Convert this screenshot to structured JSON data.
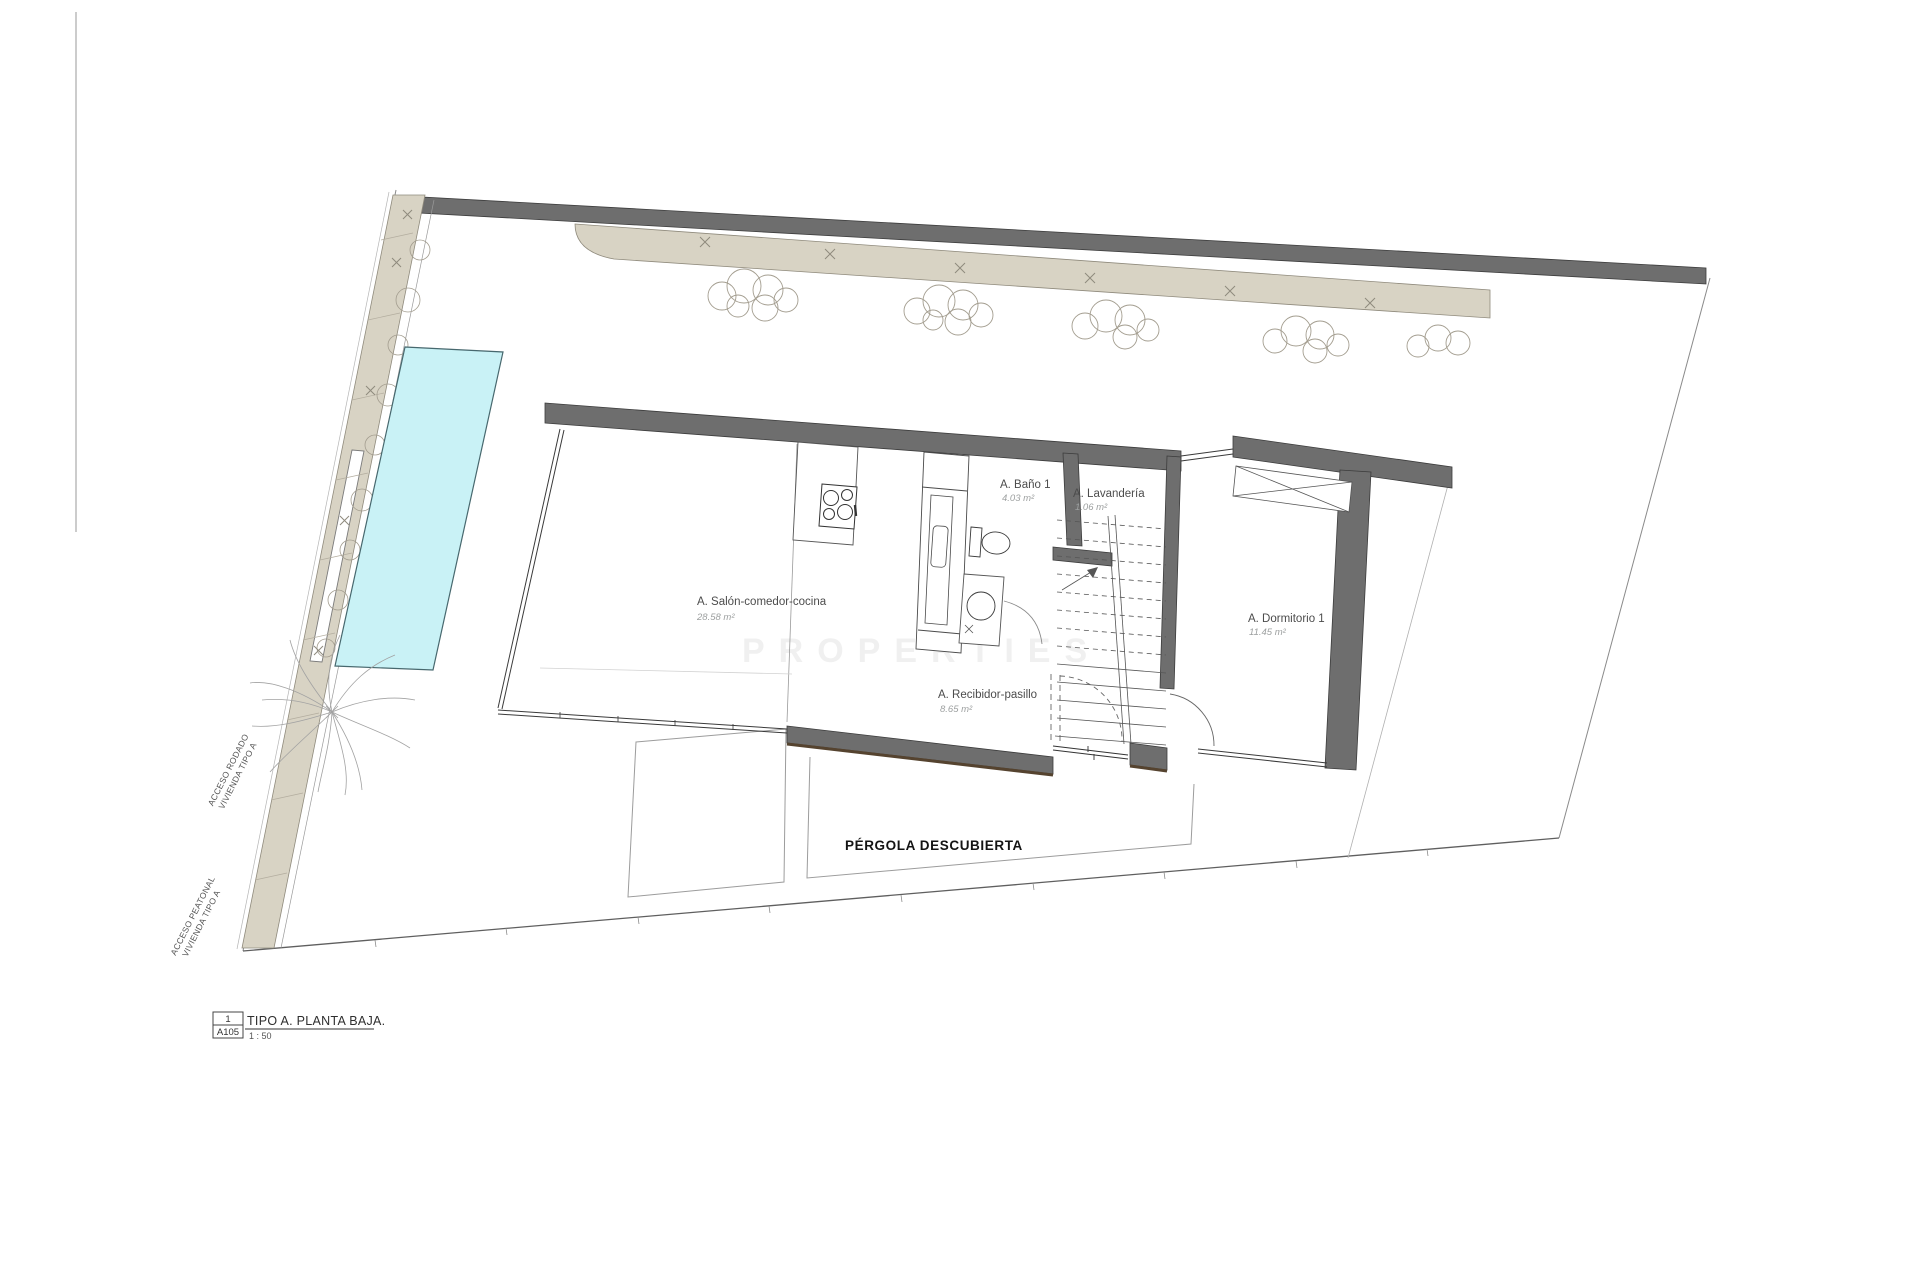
{
  "drawing": {
    "title_block": {
      "index": "1",
      "sheet": "A105",
      "title": "TIPO A. PLANTA BAJA.",
      "scale": "1 : 50"
    },
    "rooms": {
      "salon": {
        "name": "A. Salón-comedor-cocina",
        "area": "28.58 m²"
      },
      "bano": {
        "name": "A. Baño 1",
        "area": "4.03 m²"
      },
      "lavanderia": {
        "name": "A. Lavandería",
        "area": "1.06 m²"
      },
      "dormitorio": {
        "name": "A. Dormitorio 1",
        "area": "11.45 m²"
      },
      "recibidor": {
        "name": "A. Recibidor-pasillo",
        "area": "8.65 m²"
      }
    },
    "outdoor": {
      "pergola": "PÉRGOLA DESCUBIERTA"
    },
    "access": {
      "rodado_line1": "ACCESO RODADO",
      "rodado_line2": "VIVIENDA TIPO A",
      "peatonal_line1": "ACCESO PEATONAL",
      "peatonal_line2": "VIVIENDA TIPO A"
    },
    "watermark": "PROPERTIES",
    "colors": {
      "wall": "#6e6e6e",
      "wall_edge": "#55432f",
      "pool": "#c9f2f6",
      "vegetation": "#d8d3c4",
      "line": "#777777"
    }
  }
}
